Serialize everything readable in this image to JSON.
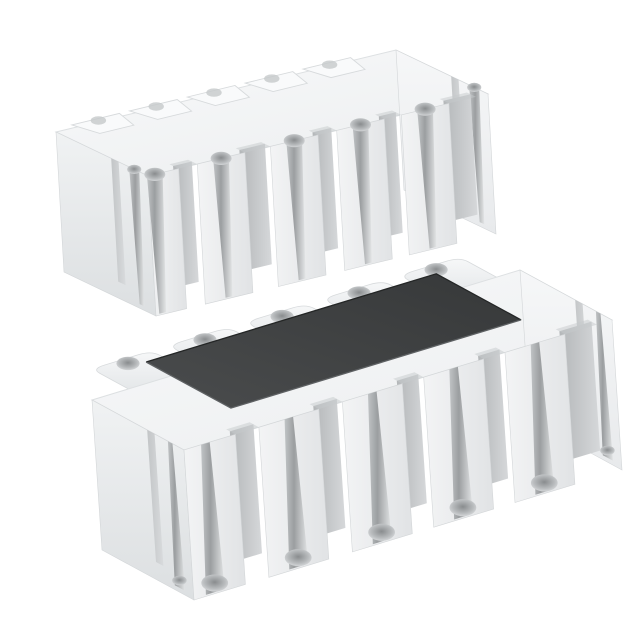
{
  "meta": {
    "type": "product-render",
    "description": "3D rendering of two white ceramic chip resistor array packages with castellated edge terminals on a plain white background; the upper component is shown bottom side up exposing terminal pads, the lower component is shown top side up with a dark protective resistive coating",
    "background": "#ffffff"
  },
  "palette": {
    "background": "#ffffff",
    "ceramic_top": "#f8f9fa",
    "ceramic_top_dark": "#edeff0",
    "end_light": "#f0f2f3",
    "end_dark": "#dcdfe1",
    "end_bright_light": "#f6f7f8",
    "end_bright_dark": "#e8eaec",
    "face_light": "#f3f4f5",
    "face_dark": "#e1e3e5",
    "slot_dark": "#b4b7b9",
    "slot_light": "#d6d8da",
    "groove_edge": "#c0c3c5",
    "groove_dark": "#9b9ea0",
    "groove_light": "#e3e5e6",
    "bump_light": "#f6f7f8",
    "bump_dark": "#e4e7e9",
    "notch_shadow": "#c6c9cb",
    "pad_fill": "#f9fafb",
    "pad_stroke": "#d7dadc",
    "edge_stroke": "#dde0e2",
    "block_stroke": "#d3d6d8",
    "coating_light": "#4a4c4d",
    "coating_dark": "#363839",
    "coating_edge_light": "#5e6163",
    "coating_edge_dark": "#242626",
    "bulb_core": "#898c8e",
    "bulb_mid": "#b9bcbe",
    "bulb_rim": "#dadcde"
  },
  "components": [
    {
      "id": "resistor-array-bottom-view",
      "caption": "white ceramic chip array, bottom (terminal) side facing up",
      "orientation": "bottom-up",
      "origin": [
        56,
        132
      ],
      "axis_u": [
        340,
        -82
      ],
      "axis_v": [
        92,
        44
      ],
      "thickness": [
        8,
        140
      ],
      "terminal_half_width": 0.07,
      "front_terminal_centers": [
        0.02,
        0.215,
        0.43,
        0.625,
        0.815
      ],
      "rear_terminal_centers": [
        0.13,
        0.3,
        0.47,
        0.64,
        0.81
      ],
      "coating": null
    },
    {
      "id": "resistor-array-top-view",
      "caption": "white ceramic chip array, top side facing up with dark resistive coating",
      "orientation": "top-up",
      "origin": [
        92,
        400
      ],
      "axis_u": [
        428,
        -130
      ],
      "axis_v": [
        92,
        50
      ],
      "thickness": [
        10,
        150
      ],
      "terminal_half_width": 0.07,
      "front_terminal_centers": [
        0.05,
        0.245,
        0.44,
        0.63,
        0.82
      ],
      "rear_terminal_centers": [
        0.155,
        0.335,
        0.515,
        0.695,
        0.875
      ],
      "coating": {
        "u0": 0.186,
        "v0": -0.277,
        "u1": 0.864,
        "v1": 0.645
      }
    }
  ]
}
